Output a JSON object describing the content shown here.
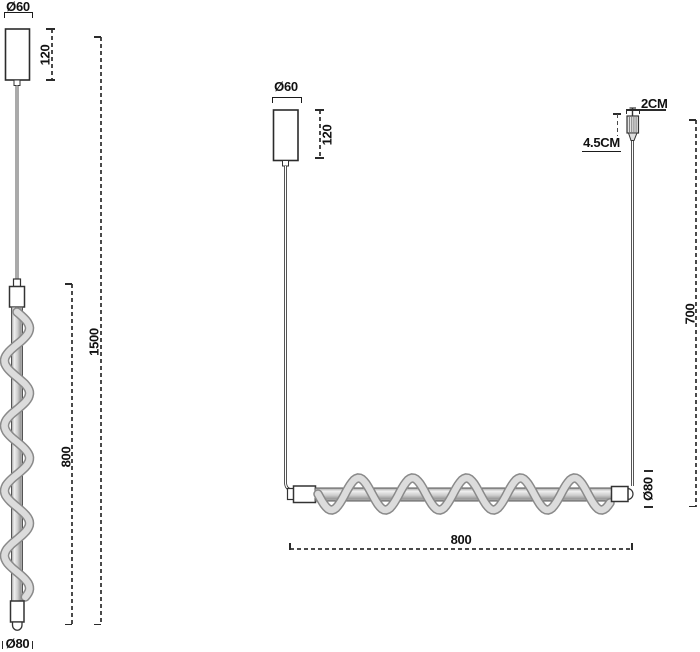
{
  "diagram": {
    "type": "technical-dimension-drawing",
    "subject": "spiral pendant lamps",
    "line_color": "#2b2b2b",
    "dash_color": "#4a4a4a",
    "spiral_fill": "#dcdcdc",
    "spiral_edge": "#8a8a8a",
    "left_figure": {
      "name": "vertical spiral pendant",
      "labels": {
        "canopy_diameter": "Ø60",
        "canopy_height": "120",
        "overall_height": "1500",
        "spiral_section_height": "800",
        "bottom_diameter": "Ø80"
      }
    },
    "right_figure": {
      "name": "horizontal spiral pendant",
      "labels": {
        "canopy_diameter": "Ø60",
        "canopy_height": "120",
        "cord_grip_width": "2CM",
        "cord_grip_length": "4.5CM",
        "suspension_height": "700",
        "tube_diameter": "Ø80",
        "bar_length": "800"
      }
    }
  }
}
